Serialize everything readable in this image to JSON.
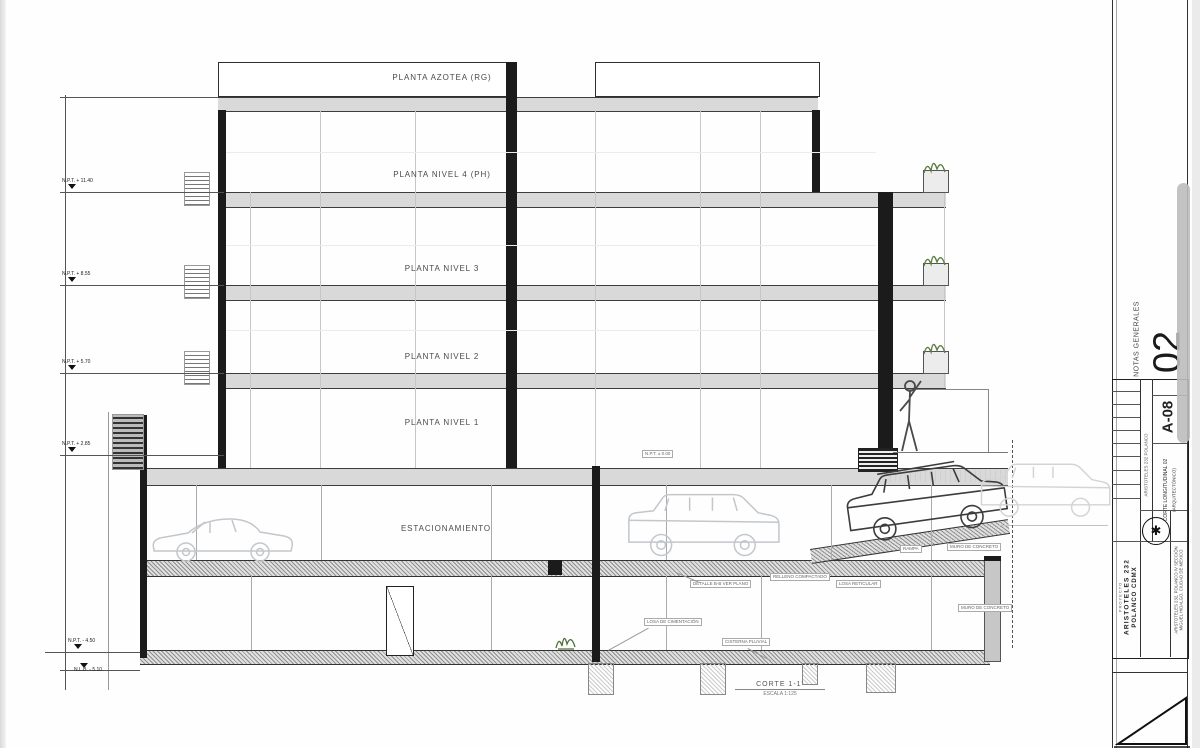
{
  "floors": [
    {
      "text": "PLANTA AZOTEA (RG)"
    },
    {
      "text": "PLANTA NIVEL 4 (PH)"
    },
    {
      "text": "PLANTA NIVEL 3"
    },
    {
      "text": "PLANTA NIVEL 2"
    },
    {
      "text": "PLANTA NIVEL 1"
    },
    {
      "text": "ESTACIONAMIENTO"
    }
  ],
  "levels": [
    {
      "label": "N.P.T. + 11.40"
    },
    {
      "label": "N.P.T. + 8.55"
    },
    {
      "label": "N.P.T. + 5.70"
    },
    {
      "label": "N.P.T. + 2.85"
    },
    {
      "label": "N.P.T. - 4.50"
    },
    {
      "label": "N.L.B. - 5.10"
    }
  ],
  "annotations": [
    {
      "text": "N.P.T. ± 0.00"
    },
    {
      "text": "DETALLE B-B VER PLANO"
    },
    {
      "text": "LOSA DE CIMENTACIÓN"
    },
    {
      "text": "LOSA RETICULAR"
    },
    {
      "text": "MURO DE CONCRETO"
    },
    {
      "text": "MURO DE CONCRETO"
    },
    {
      "text": "RELLENO COMPACTADO"
    },
    {
      "text": "CISTERNA PLUVIAL"
    },
    {
      "text": "RAMPA"
    }
  ],
  "section": {
    "title": "CORTE 1-1'",
    "scale": "ESCALA 1:125"
  },
  "titleblock": {
    "notes_label": "NOTAS GENERALES",
    "sheet_big": "02",
    "sheet_code": "A-08",
    "firm": "ARISTOTELES 232 POLANCO",
    "drawing_title": "CORTE LONGITUDINAL 02",
    "drawing_subtitle": "(ARQUITECTÓNICO)",
    "project_label": "PROYECTO",
    "project_name": "ARISTOTELES 232",
    "project_city": "POLANCO CDMX",
    "address1": "ARISTOTELES 232, POLANCO IV SECCIÓN",
    "address2": "MIGUEL HIDALGO, CIUDAD DE MÉXICO",
    "logo_glyph": "✱"
  },
  "colors": {
    "slab_gray": "#d9d9d9",
    "line_dark": "#1b1b1b",
    "plant_green": "#5c7d3f"
  }
}
